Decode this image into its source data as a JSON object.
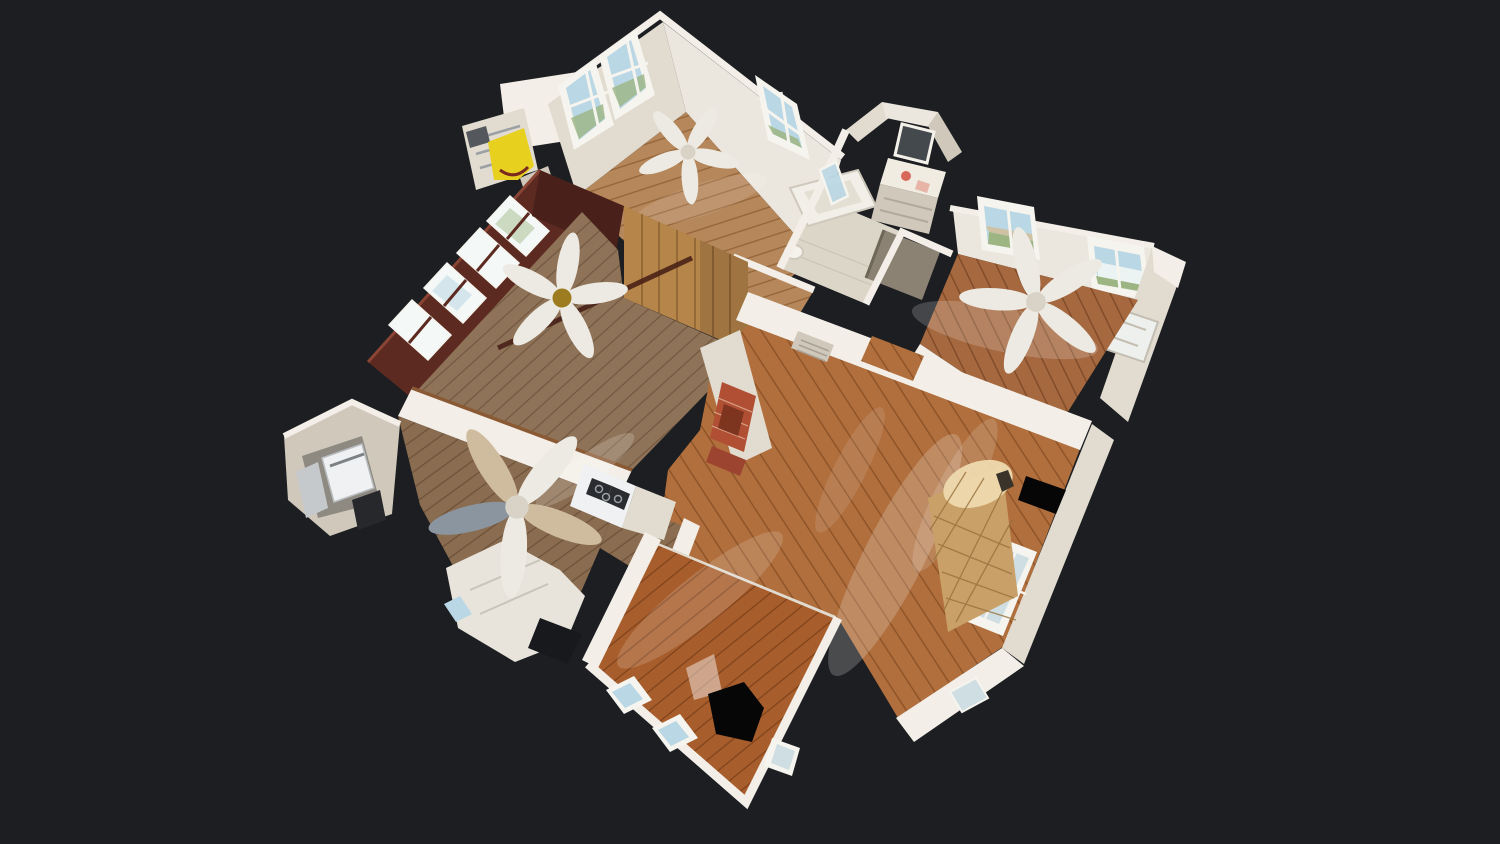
{
  "scene": {
    "view": "dollhouse-3d-cutaway",
    "rooms": [
      "front-bedroom",
      "wood-paneled-den",
      "hallway",
      "bathroom",
      "right-bedroom",
      "living-room",
      "kitchen",
      "laundry-nook",
      "rear-bedroom"
    ],
    "objects": [
      "ceiling-fan",
      "bathtub",
      "vanity-mirror",
      "toilet",
      "stove",
      "washer",
      "sink-counter",
      "fireplace-hearth",
      "wicker-bench",
      "window",
      "scan-hole",
      "yellow-step-stool",
      "shelf-cabinet"
    ]
  },
  "palette": {
    "background": "#1c1e21",
    "wall_top": "#f3efe8",
    "wall_bright": "#ece7de",
    "wall_light": "#e1dbd0",
    "wall_mid": "#cfc8bb",
    "tile": "#dcd6c8",
    "wood_front": "#b5875a",
    "wood_front_line": "#96663a",
    "wood_den": "#8f7358",
    "wood_den_line": "#6f563d",
    "wood_kitchen": "#8a6c50",
    "wood_kitchen_line": "#6a4f36",
    "wood_living": "#b06f3d",
    "wood_living_line": "#8d5226",
    "wood_bottom": "#a85e2c",
    "wood_bottom_line": "#83441c",
    "wood_right": "#a5683f",
    "wood_right_line": "#7f4a28",
    "mahogany": "#5c2a20",
    "mahogany_dark": "#49211a",
    "mahogany_hi": "#8a4534",
    "pine": "#b5854a",
    "pine_line": "#8a6030",
    "window_sky": "#b9d7e4",
    "window_green": "#9cb583",
    "window_glow": "#f4f8f6",
    "window_frame": "#f6f4ee",
    "brick": "#b04f33",
    "brick_dark": "#7e3520",
    "scan_hole": "#060607",
    "yellow_item": "#e8d01f",
    "brass": "#9c7c1e",
    "fan_blade": "#eceae2",
    "fan_tan": "#cfbc9e",
    "bed_tan": "#c9a168",
    "bed_line": "#97713c",
    "appliance_white": "#eff1f2",
    "appliance_gray": "#c6c9cc",
    "stove_dark": "#2a2c2f",
    "metal": "#9aa0a6",
    "door_gray": "#8b8274"
  }
}
